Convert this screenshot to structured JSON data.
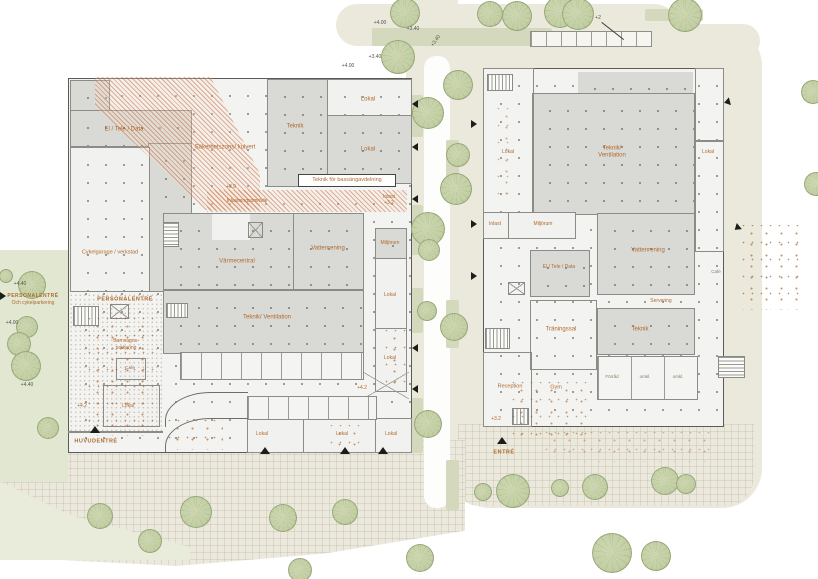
{
  "colors": {
    "label_accent": "#b06a2e",
    "wall": "#5a5a56",
    "room_gray": "#d9dad6",
    "hatch_orange": "#c97342",
    "site_beige": "#ebe8dc",
    "park_green": "#e2e7d1",
    "tree_green": "#c3cfa4",
    "level_text": "#55534d"
  },
  "left": {
    "el_tele_data": "El / Tele / Data",
    "sakerhetszon": "Säkerhetszons/ kulvert",
    "teknik": "Teknik",
    "lokal_top": "Lokal",
    "lokal_top2": "Lokal",
    "teknik_bassang": "Teknik för bassängavdelning",
    "level_39": "+3.9",
    "inlastningsomrade": "Inlastningsområde",
    "inlast": "Inlast",
    "inlast_level": "+3.2",
    "cykelgarage": "Cykelgarage / verkstad",
    "varmecentral": "Värmecentral",
    "vattenrening": "Vattenrening",
    "miljorum": "Miljörum",
    "teknik_ventilation": "Teknik/ Ventilation",
    "lokal_east1": "Lokal",
    "lokal_east2": "Lokal",
    "personalentre": "PERSONALENTRÉ",
    "barnvagns1": "Barnvagns-",
    "barnvagns2": "parkering",
    "cafe": "Cafe",
    "lokal_hall": "Lokal",
    "level_42a": "+4.2",
    "level_42b": "+4.2",
    "huvudentre": "HUVUDENTRÉ",
    "lokal_s1": "Lokal",
    "lokal_s2": "Lokal",
    "lokal_s3": "Lokal"
  },
  "right": {
    "lokal_west": "Lokal",
    "teknik_ventilation1": "Teknik/",
    "teknik_ventilation2": "Ventilation",
    "lokal_east": "Lokal",
    "inlast": "Inlast",
    "miljorum": "Miljörum",
    "vattenrening": "Vattenrening",
    "el_tele_data": "El / Tele / Data",
    "servering": "Servering",
    "traningssal": "Träningssal",
    "teknik": "Teknik",
    "forrad": "Förråd",
    "omkl1": "omkl.",
    "omkl2": "omkl.",
    "reception": "Reception",
    "gym": "Gym",
    "cafe": "Cafe",
    "level_32": "+3.2",
    "entre": "ENTRÉ"
  },
  "site": {
    "personalentre1": "PERSONALENTRÉ",
    "personalentre2": "Och cykelparkering",
    "elev_w1": "+4.40",
    "elev_w2": "+4.00",
    "elev_w3": "+4.40",
    "elev_t1": "+4.00",
    "elev_t2": "+3.40",
    "elev_t3": "+3.40",
    "elev_t4": "+3.40",
    "elev_t5": "+4.00",
    "bike_elev": "+2"
  }
}
